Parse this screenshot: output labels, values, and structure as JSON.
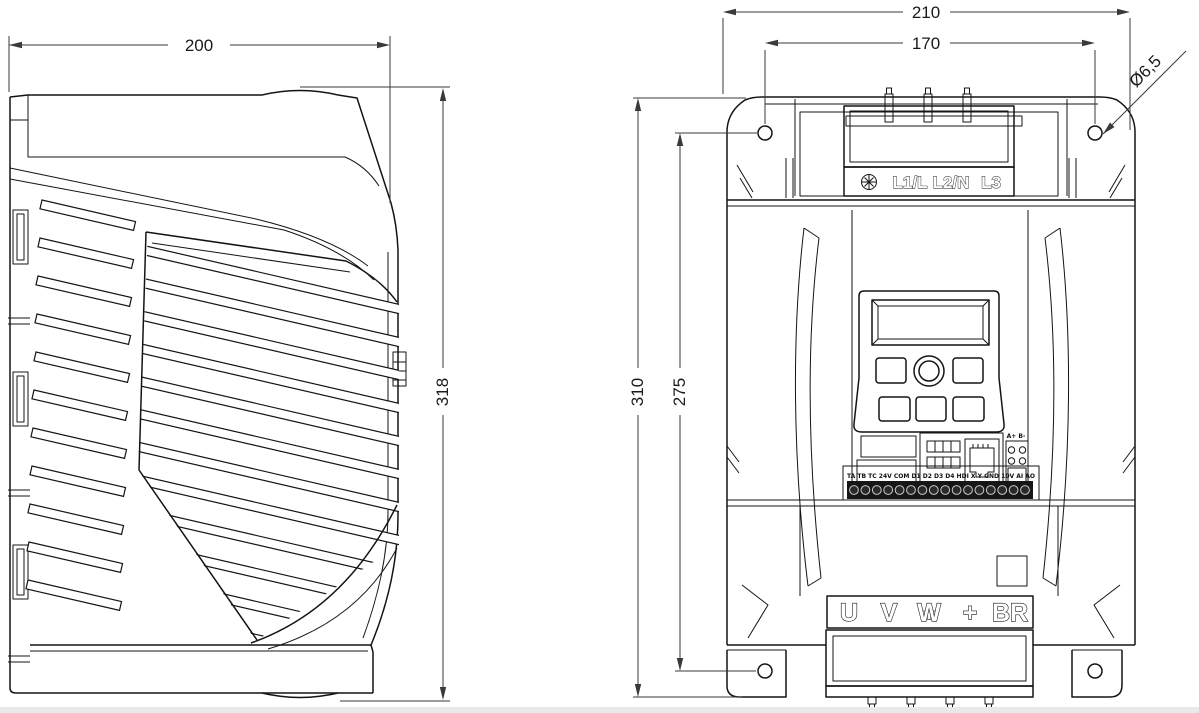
{
  "drawing": {
    "type": "mechanical-dimension-drawing",
    "views": {
      "left": "side-view",
      "right": "front-view"
    }
  },
  "dimensions": {
    "side_width": "200",
    "side_height": "318",
    "front_width": "210",
    "hole_spacing_h": "170",
    "front_height": "310",
    "hole_spacing_v": "275",
    "hole_diameter": "Ø6,5"
  },
  "labels": {
    "input_terminals": [
      "L1/L",
      "L2/N",
      "L3"
    ],
    "output_terminals": [
      "U",
      "V",
      "W",
      "+",
      "BR"
    ],
    "control_terminals": "TA TB TC 24V COM D1 D2 D3 D4 HDI X Y GND 10V AI AO",
    "comm_terminals": "A+ B-"
  },
  "colors": {
    "line": "#141414",
    "dimension": "#3a3a3a",
    "background": "#ffffff"
  }
}
